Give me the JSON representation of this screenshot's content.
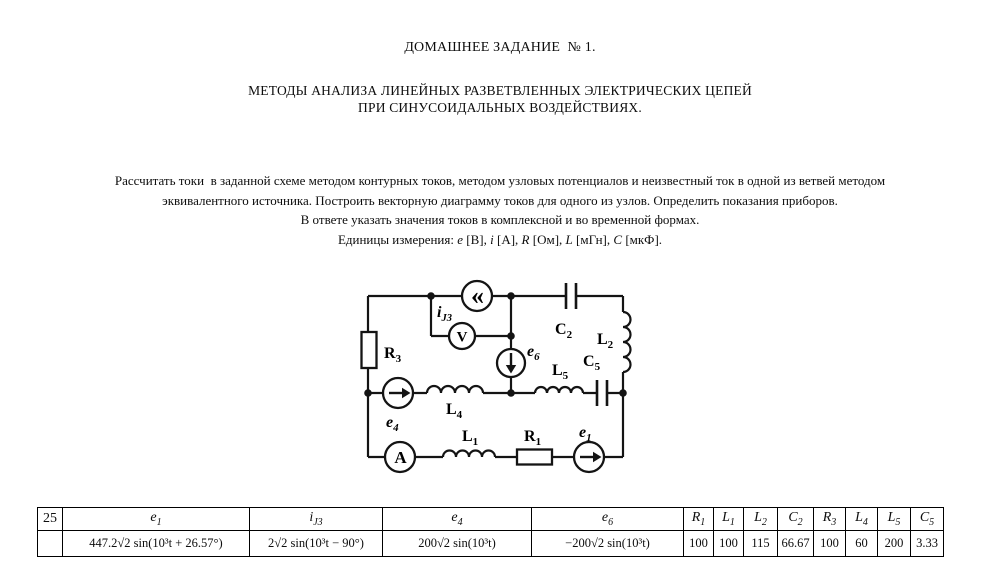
{
  "page": {
    "title1": "ДОМАШНЕЕ ЗАДАНИЕ  № 1.",
    "title2_line1": "МЕТОДЫ АНАЛИЗА ЛИНЕЙНЫХ РАЗВЕТВЛЕННЫХ ЭЛЕКТРИЧЕСКИХ ЦЕПЕЙ",
    "title2_line2": "ПРИ СИНУСОИДАЛЬНЫХ ВОЗДЕЙСТВИЯХ.",
    "task_line1": "Рассчитать токи  в заданной схеме методом контурных токов, методом узловых потенциалов и неизвестный ток в одной из ветвей методом",
    "task_line2": "эквивалентного источника. Построить векторную диаграмму токов для одного из узлов. Определить показания приборов.",
    "task_line3": "В ответе указать значения токов в комплексной и во временной формах.",
    "units_prefix": "Единицы измерения: ",
    "units": [
      {
        "sym": "e",
        "rest": " [В], "
      },
      {
        "sym": "i",
        "rest": " [А], "
      },
      {
        "sym": "R",
        "rest": " [Ом], "
      },
      {
        "sym": "L",
        "rest": " [мГн], "
      },
      {
        "sym": "C",
        "rest": " [мкФ]."
      }
    ]
  },
  "circuit": {
    "labels": {
      "r3": {
        "base": "R",
        "sub": "3"
      },
      "ij3": {
        "base": "i",
        "sub": "J3"
      },
      "c2": {
        "base": "C",
        "sub": "2"
      },
      "l2": {
        "base": "L",
        "sub": "2"
      },
      "c5": {
        "base": "C",
        "sub": "5"
      },
      "l5": {
        "base": "L",
        "sub": "5"
      },
      "e6": {
        "base": "e",
        "sub": "6"
      },
      "e4": {
        "base": "e",
        "sub": "4"
      },
      "l4": {
        "base": "L",
        "sub": "4"
      },
      "l1": {
        "base": "L",
        "sub": "1"
      },
      "r1": {
        "base": "R",
        "sub": "1"
      },
      "e1": {
        "base": "e",
        "sub": "1"
      },
      "ammeter": "A",
      "voltmeter": "V",
      "current_source": "«"
    }
  },
  "table": {
    "variant": "25",
    "headers": [
      {
        "base": "e",
        "sub": "1"
      },
      {
        "base": "i",
        "sub": "J3"
      },
      {
        "base": "e",
        "sub": "4"
      },
      {
        "base": "e",
        "sub": "6"
      },
      {
        "base": "R",
        "sub": "1"
      },
      {
        "base": "L",
        "sub": "1"
      },
      {
        "base": "L",
        "sub": "2"
      },
      {
        "base": "C",
        "sub": "2"
      },
      {
        "base": "R",
        "sub": "3"
      },
      {
        "base": "L",
        "sub": "4"
      },
      {
        "base": "L",
        "sub": "5"
      },
      {
        "base": "C",
        "sub": "5"
      }
    ],
    "values": [
      "447.2√2 sin(10³t + 26.57°)",
      "2√2 sin(10³t − 90°)",
      "200√2 sin(10³t)",
      "−200√2 sin(10³t)",
      "100",
      "100",
      "115",
      "66.67",
      "100",
      "60",
      "200",
      "3.33"
    ]
  }
}
